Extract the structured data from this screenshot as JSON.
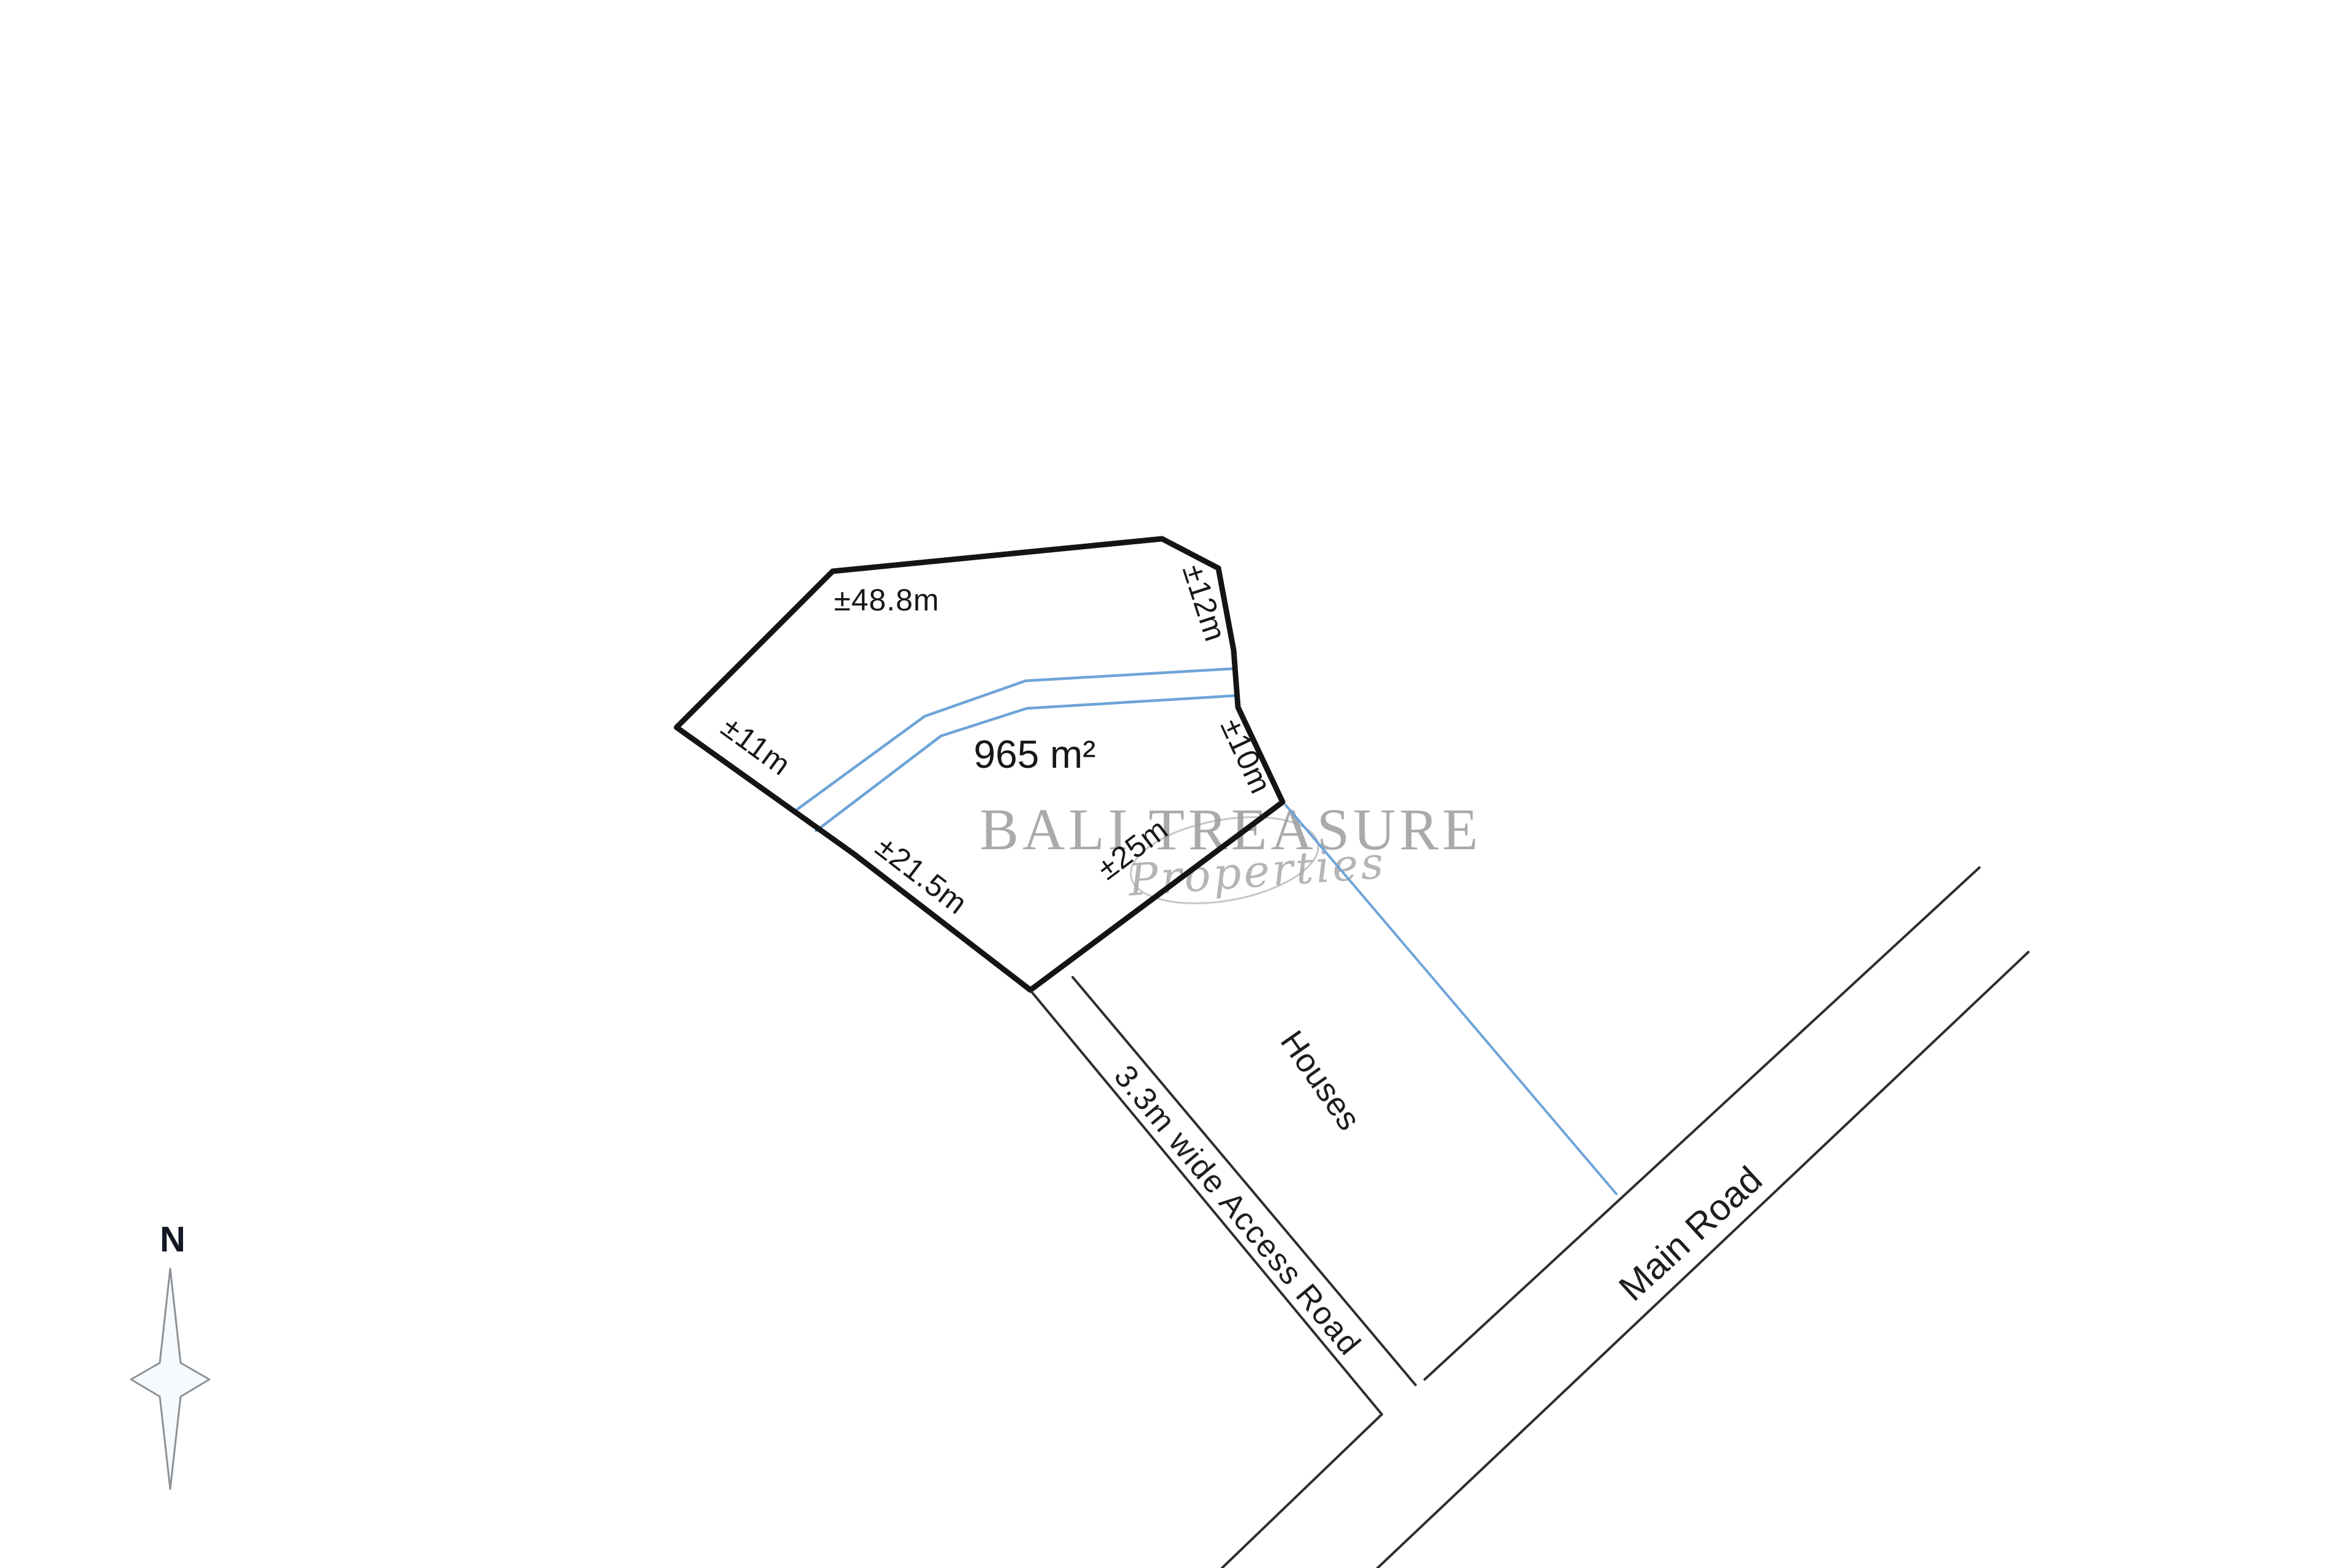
{
  "diagram": {
    "type": "land-plot-survey",
    "plot": {
      "area_label": "965 m²",
      "boundaries": {
        "north": "±48.8m",
        "northeast": "±12m",
        "east": "±10m",
        "southeast": "±25m",
        "southwest": "±21.5m",
        "west": "±11m"
      }
    },
    "roads": {
      "access_road_label": "3.3m wide Access Road",
      "main_road_label": "Main Road"
    },
    "surroundings": {
      "houses_label": "Houses"
    },
    "compass": {
      "north_label": "N"
    },
    "watermark": {
      "brand": "BALI TREASURE",
      "sub": "Properties"
    },
    "colors": {
      "plot_boundary": "#141414",
      "road_line": "#2e2e2e",
      "water_line": "#6ea4d8",
      "label_text": "#171717",
      "watermark_gray": "#9c9c9c",
      "compass_fill": "#f7fafc",
      "compass_stroke": "#8c9196"
    }
  }
}
